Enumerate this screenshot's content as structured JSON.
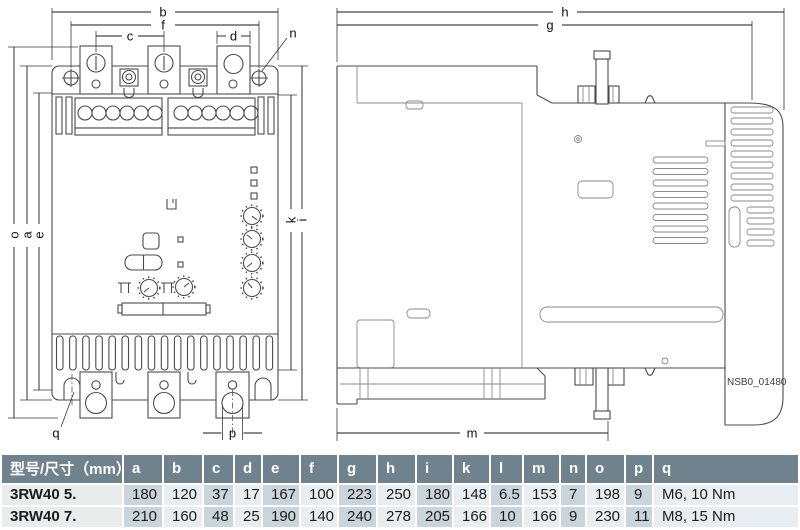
{
  "drawing": {
    "dims": {
      "a": "a",
      "b": "b",
      "c": "c",
      "d": "d",
      "e": "e",
      "f": "f",
      "g": "g",
      "h": "h",
      "i": "i",
      "k": "k",
      "m": "m",
      "n": "n",
      "o": "o",
      "p": "p",
      "q": "q"
    },
    "figure_id": "NSB0_01480"
  },
  "table": {
    "headers": [
      "型号/尺寸（mm）",
      "a",
      "b",
      "c",
      "d",
      "e",
      "f",
      "g",
      "h",
      "i",
      "k",
      "l",
      "m",
      "n",
      "o",
      "p",
      "q"
    ],
    "rows": [
      [
        "3RW40 5.",
        "180",
        "120",
        "37",
        "17",
        "167",
        "100",
        "223",
        "250",
        "180",
        "148",
        "6.5",
        "153",
        "7",
        "198",
        "9",
        "M6, 10 Nm"
      ],
      [
        "3RW40 7.",
        "210",
        "160",
        "48",
        "25",
        "190",
        "140",
        "240",
        "278",
        "205",
        "166",
        "10",
        "166",
        "9",
        "230",
        "11",
        "M8, 15 Nm"
      ]
    ]
  }
}
